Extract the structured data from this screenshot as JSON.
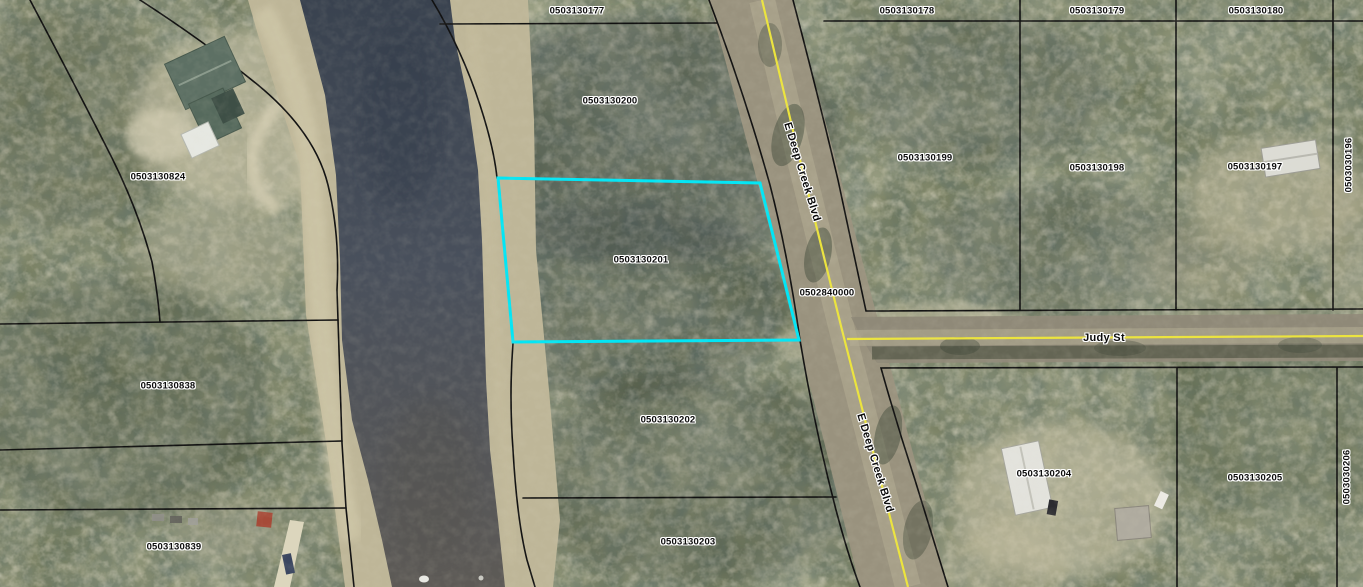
{
  "map": {
    "type": "aerial-parcel-map",
    "highlighted_parcel_id": "0503130201",
    "road_names": [
      "E Deep Creek Blvd",
      "Judy St"
    ],
    "colors": {
      "highlight_outline": "#00e6f6",
      "parcel_line": "#111111",
      "road_centerline": "#ece43c",
      "water": "#465160",
      "sand_bank": "#beb698"
    },
    "parcel_labels": [
      {
        "text": "0503130177",
        "x": 577,
        "y": 11,
        "rot": 0
      },
      {
        "text": "0503130178",
        "x": 907,
        "y": 11,
        "rot": 0
      },
      {
        "text": "0503130179",
        "x": 1097,
        "y": 11,
        "rot": 0
      },
      {
        "text": "0503130180",
        "x": 1256,
        "y": 11,
        "rot": 0
      },
      {
        "text": "0503130200",
        "x": 610,
        "y": 101,
        "rot": 0
      },
      {
        "text": "0503130199",
        "x": 925,
        "y": 158,
        "rot": 0
      },
      {
        "text": "0503130198",
        "x": 1097,
        "y": 168,
        "rot": 0
      },
      {
        "text": "0503130197",
        "x": 1255,
        "y": 167,
        "rot": 0
      },
      {
        "text": "0503030196",
        "x": 1349,
        "y": 165,
        "rot": -90
      },
      {
        "text": "0503130824",
        "x": 158,
        "y": 177,
        "rot": 0
      },
      {
        "text": "0503130201",
        "x": 641,
        "y": 260,
        "rot": 0
      },
      {
        "text": "0502840000",
        "x": 827,
        "y": 293,
        "rot": 0
      },
      {
        "text": "0503130838",
        "x": 168,
        "y": 386,
        "rot": 0
      },
      {
        "text": "0503130202",
        "x": 668,
        "y": 420,
        "rot": 0
      },
      {
        "text": "0503130204",
        "x": 1044,
        "y": 474,
        "rot": 0
      },
      {
        "text": "0503130205",
        "x": 1255,
        "y": 478,
        "rot": 0
      },
      {
        "text": "0503030206",
        "x": 1347,
        "y": 477,
        "rot": -90
      },
      {
        "text": "0503130203",
        "x": 688,
        "y": 542,
        "rot": 0
      },
      {
        "text": "0503130839",
        "x": 174,
        "y": 547,
        "rot": 0
      }
    ],
    "road_labels": [
      {
        "text": "E Deep Creek Blvd",
        "x": 802,
        "y": 172,
        "rot": 73
      },
      {
        "text": "Judy St",
        "x": 1104,
        "y": 338,
        "rot": 0
      },
      {
        "text": "E Deep Creek Blvd",
        "x": 875,
        "y": 463,
        "rot": 73
      }
    ]
  }
}
